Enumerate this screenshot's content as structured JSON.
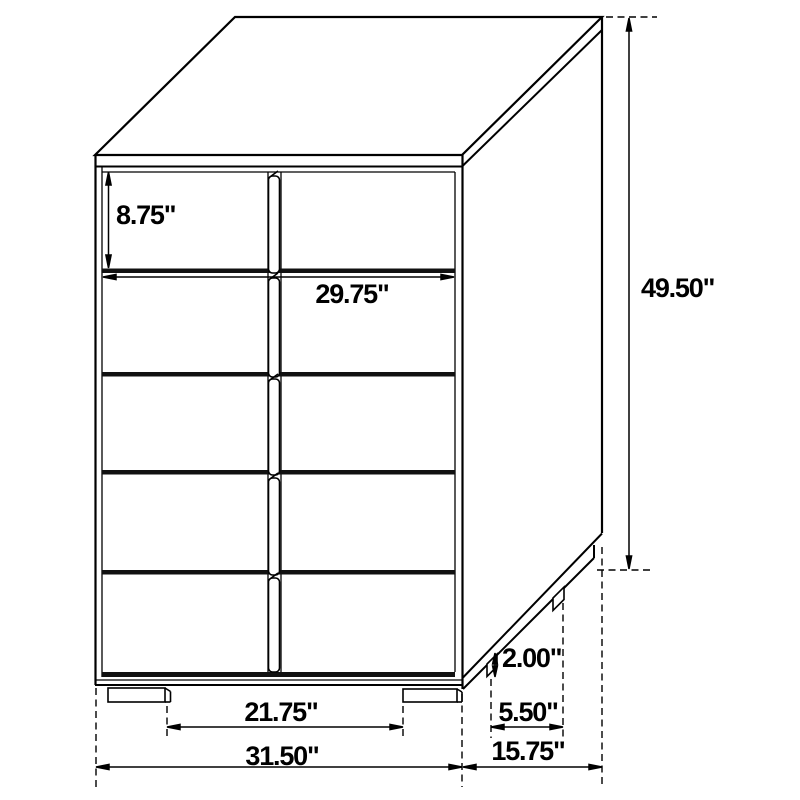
{
  "diagram": {
    "type": "furniture-dimension-drawing",
    "subject": "five-drawer two-column chest shown in oblique line-art projection with dimension callouts",
    "unit": "inches",
    "background_color": "#ffffff",
    "line_color": "#000000"
  },
  "labels": {
    "drawer_height": "8.75\"",
    "drawer_width": "29.75\"",
    "overall_height": "49.50\"",
    "foot_height": "2.00\"",
    "side_foot_spacing": "5.50\"",
    "front_foot_spacing": "21.75\"",
    "overall_width": "31.50\"",
    "overall_depth": "15.75\""
  }
}
